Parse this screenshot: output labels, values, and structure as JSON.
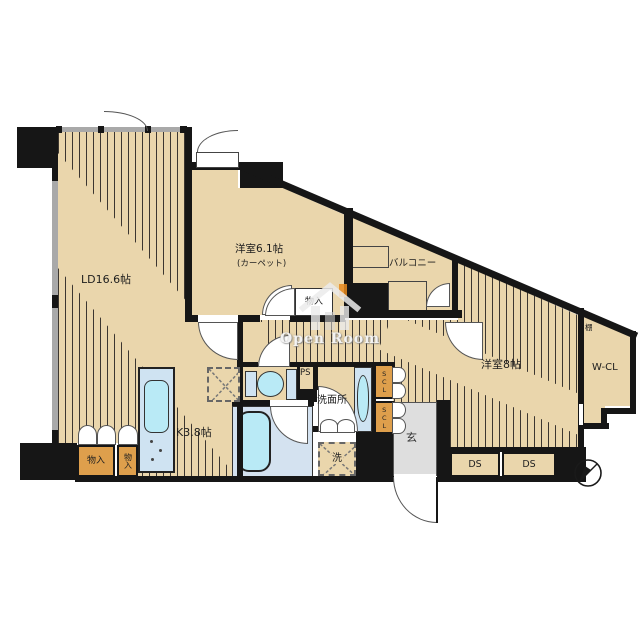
{
  "rooms": {
    "living_dining": {
      "label": "LD16.6帖"
    },
    "western_room_1": {
      "label": "洋室6.1帖",
      "sublabel": "(カーペット)"
    },
    "western_room_2": {
      "label": "洋室8帖"
    },
    "kitchen": {
      "label": "K3.8帖"
    },
    "balcony": {
      "label": "バルコニー"
    },
    "walk_in_closet": {
      "label": "W-CL"
    },
    "shelf": {
      "label": "棚"
    },
    "washroom": {
      "label": "洗面所"
    },
    "washer": {
      "label": "洗"
    },
    "pipe_space": {
      "label": "PS"
    },
    "shoe_closet_upper": {
      "label": "SCL"
    },
    "shoe_closet_lower": {
      "label": "SCL"
    },
    "entrance": {
      "label": "玄"
    },
    "duct_space_1": {
      "label": "DS"
    },
    "duct_space_2": {
      "label": "DS"
    },
    "storage_left": {
      "label": "物入"
    },
    "storage_left_2": {
      "label": "物入"
    },
    "storage_hall": {
      "label": "物入"
    }
  },
  "watermark": {
    "text": "Open Room",
    "icon": "house-icon"
  },
  "colors": {
    "floor": "#ead6ac",
    "closet": "#de9f4c",
    "water": "#cfe3f2",
    "fixture": "#b9eaf6",
    "bathfloor": "#d4e2f0",
    "genkan": "#dedede",
    "wall": "#161616",
    "window": "#a9a9a9",
    "accent": "#e8891d",
    "stripe": "#3c3630"
  }
}
